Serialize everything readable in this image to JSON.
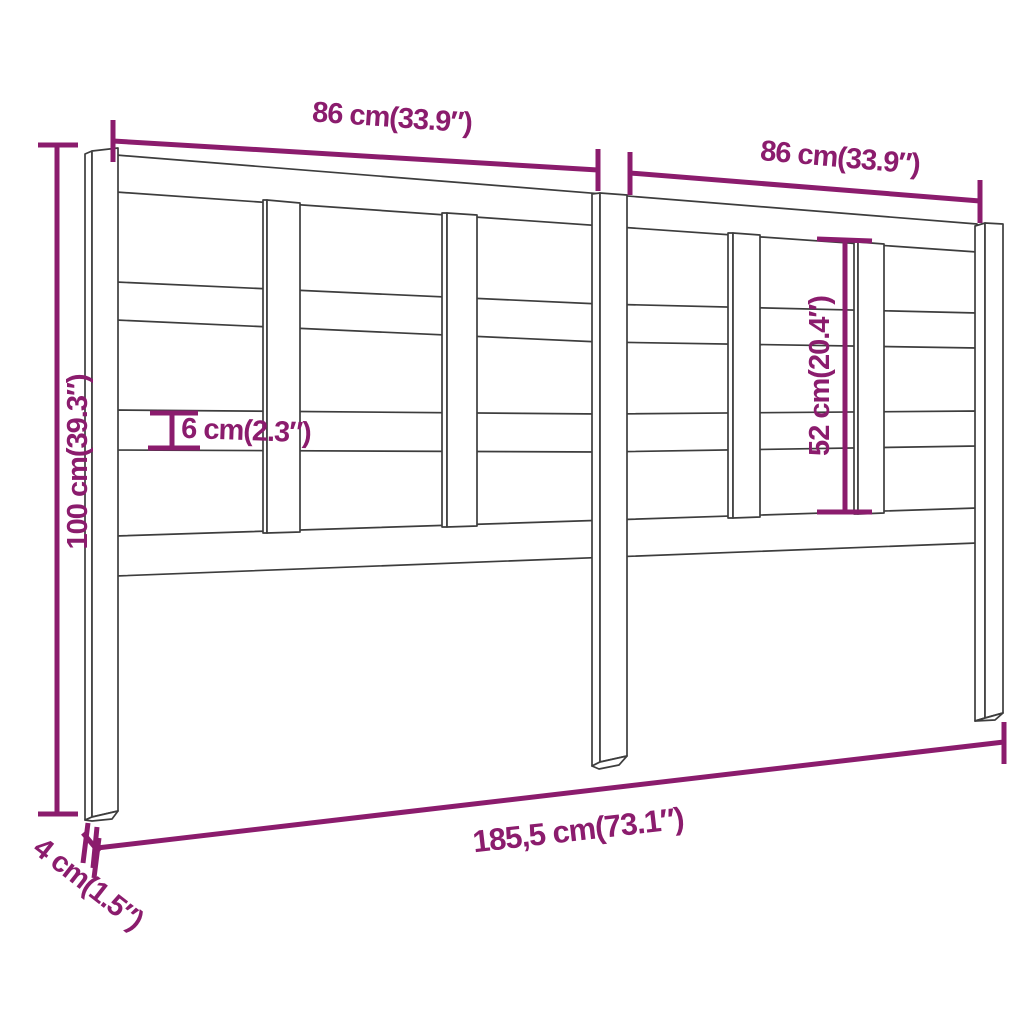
{
  "diagram": {
    "style": {
      "dimension_color": "#8b1c6d",
      "outline_color": "#3d3d3d",
      "background": "#ffffff"
    },
    "dimensions": [
      {
        "id": "top-left-width",
        "label": "86 cm(33.9″)"
      },
      {
        "id": "top-right-width",
        "label": "86 cm(33.9″)"
      },
      {
        "id": "overall-height",
        "label": "100 cm(39.3″)"
      },
      {
        "id": "slat-height",
        "label": "6 cm(2.3″)"
      },
      {
        "id": "inner-opening-height",
        "label": "52 cm(20.4″)"
      },
      {
        "id": "overall-width",
        "label": "185,5 cm(73.1″)"
      },
      {
        "id": "post-depth",
        "label": "4 cm(1.5″)"
      }
    ]
  }
}
